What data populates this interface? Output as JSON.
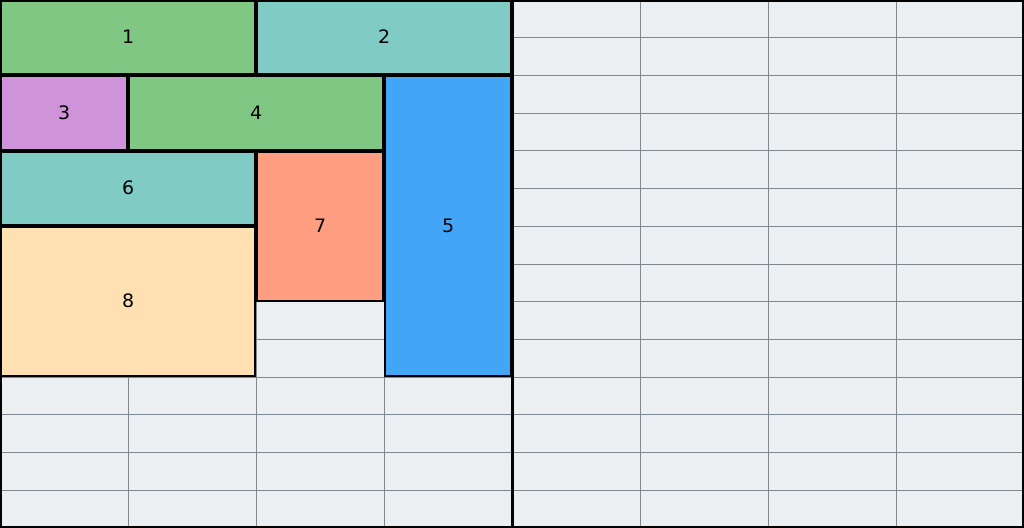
{
  "board": {
    "width": 1024,
    "height": 528,
    "cols": 8,
    "rows": 14,
    "divider_col": 4,
    "colors": {
      "cell_bg": "#eceff1",
      "gridline": "#7d878d",
      "border": "#000000",
      "divider": "#000000"
    }
  },
  "palette": {
    "green": "#81c784",
    "teal": "#80cbc4",
    "purple": "#ce93d8",
    "blue": "#42a5f5",
    "salmon": "#ff9e80",
    "peach": "#ffe0b2"
  },
  "blocks": [
    {
      "label": "1",
      "col": 0,
      "row": 0,
      "colspan": 2,
      "rowspan": 2,
      "color": "#81c784"
    },
    {
      "label": "2",
      "col": 2,
      "row": 0,
      "colspan": 2,
      "rowspan": 2,
      "color": "#80cbc4"
    },
    {
      "label": "3",
      "col": 0,
      "row": 2,
      "colspan": 1,
      "rowspan": 2,
      "color": "#ce93d8"
    },
    {
      "label": "4",
      "col": 1,
      "row": 2,
      "colspan": 2,
      "rowspan": 2,
      "color": "#81c784"
    },
    {
      "label": "5",
      "col": 3,
      "row": 2,
      "colspan": 1,
      "rowspan": 8,
      "color": "#42a5f5"
    },
    {
      "label": "6",
      "col": 0,
      "row": 4,
      "colspan": 2,
      "rowspan": 2,
      "color": "#80cbc4"
    },
    {
      "label": "7",
      "col": 2,
      "row": 4,
      "colspan": 1,
      "rowspan": 4,
      "color": "#ff9e80"
    },
    {
      "label": "8",
      "col": 0,
      "row": 6,
      "colspan": 2,
      "rowspan": 4,
      "color": "#ffe0b2"
    }
  ]
}
